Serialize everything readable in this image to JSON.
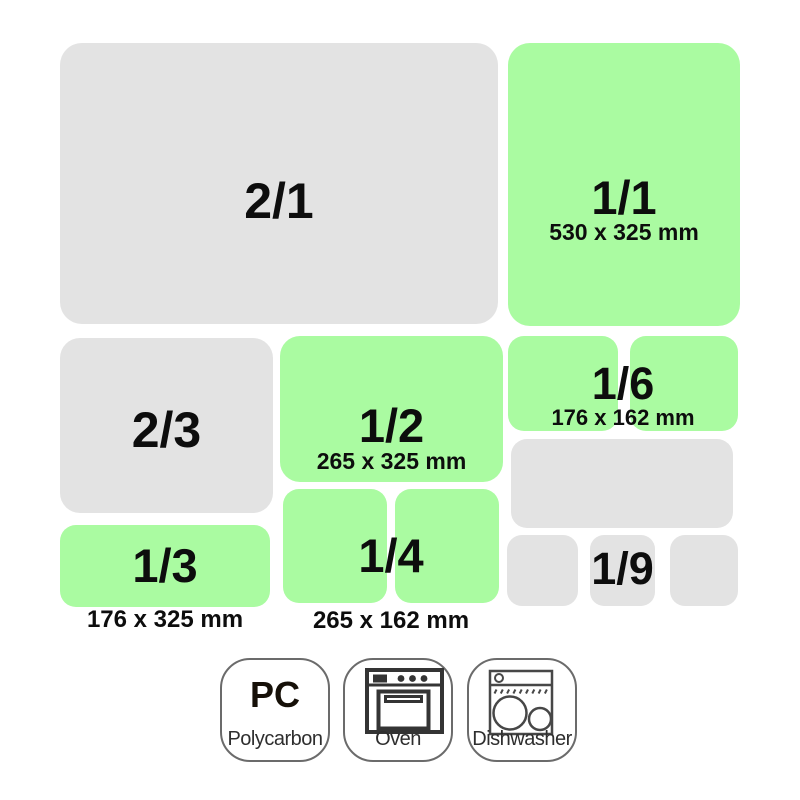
{
  "colors": {
    "green": "#aafba1",
    "gray": "#e3e3e3",
    "label": "#0d0d0d",
    "badge_border": "#6b6b6b",
    "icon_stroke": "#3f3f3f"
  },
  "pans": {
    "two_one": {
      "label": "2/1"
    },
    "one_one": {
      "label": "1/1",
      "dims": "530 x 325 mm"
    },
    "two_three": {
      "label": "2/3"
    },
    "one_two": {
      "label": "1/2",
      "dims": "265 x 325 mm"
    },
    "one_six": {
      "label": "1/6",
      "dims": "176 x 162 mm"
    },
    "one_three": {
      "label": "1/3",
      "dims": "176 x 325 mm"
    },
    "one_four": {
      "label": "1/4",
      "dims": "265 x 162 mm"
    },
    "one_nine": {
      "label": "1/9"
    }
  },
  "badges": {
    "polycarbonate": {
      "abbr": "PC",
      "label": "Polycarbon"
    },
    "oven": {
      "label": "Oven"
    },
    "dishwasher": {
      "label": "Dishwasher"
    }
  }
}
